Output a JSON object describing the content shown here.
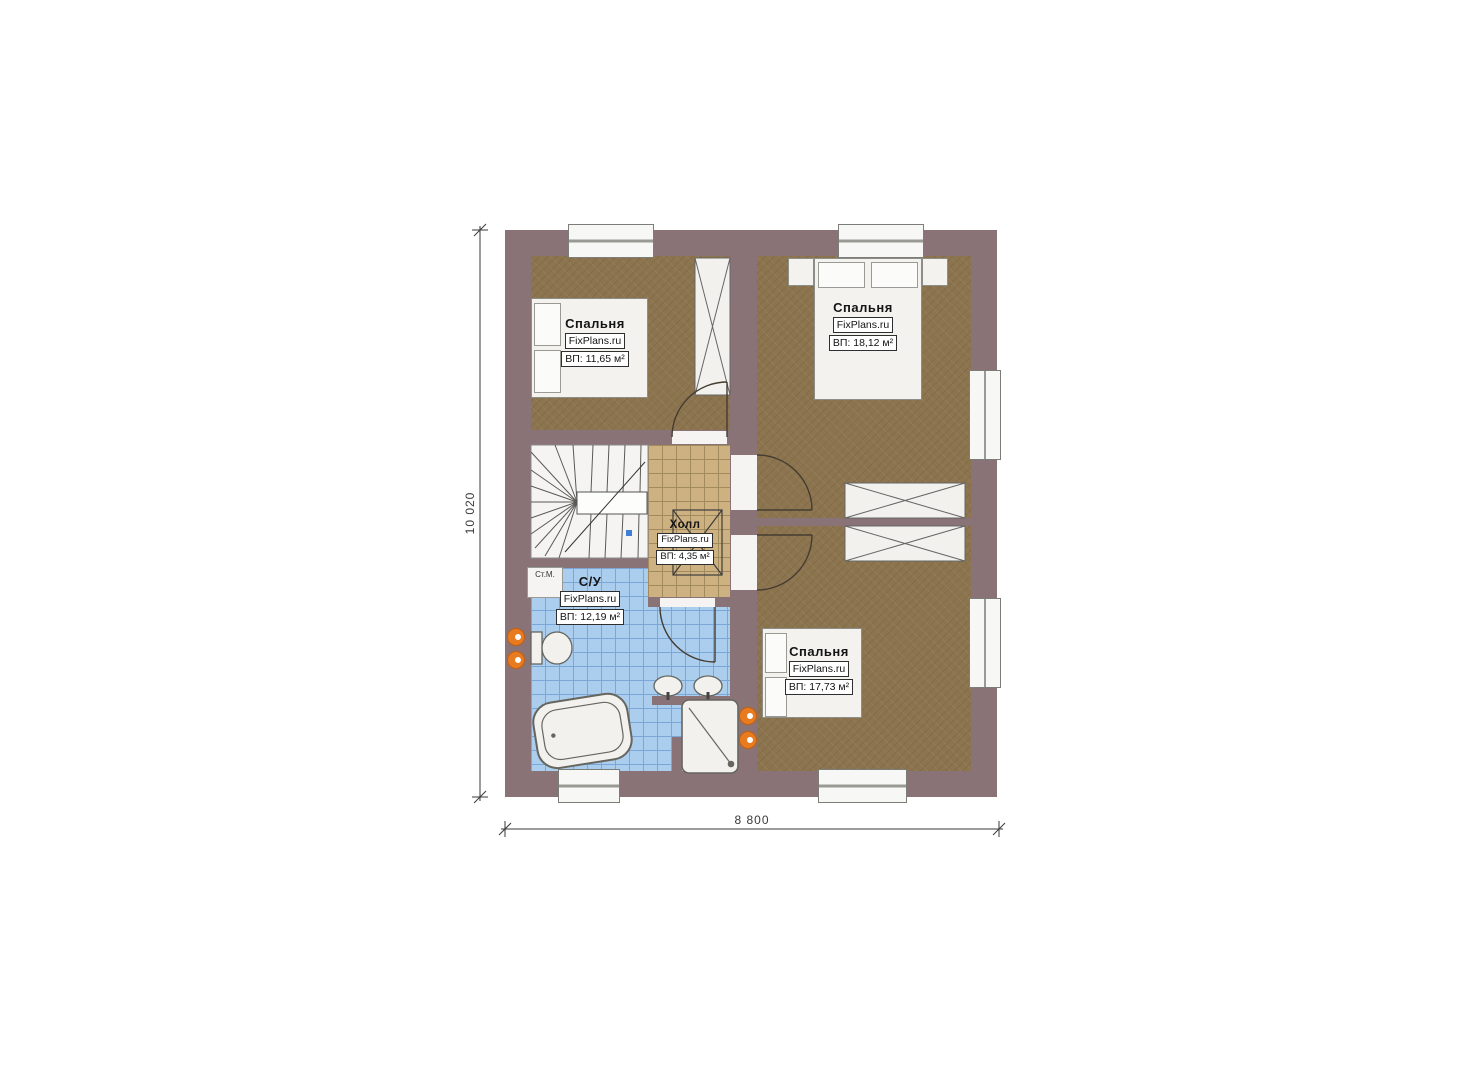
{
  "plan": {
    "rooms": {
      "bedroom_top_left": {
        "name": "Спальня",
        "brand": "FixPlans.ru",
        "area": "ВП: 11,65 м²"
      },
      "bedroom_top_right": {
        "name": "Спальня",
        "brand": "FixPlans.ru",
        "area": "ВП: 18,12 м²"
      },
      "bedroom_bottom_right": {
        "name": "Спальня",
        "brand": "FixPlans.ru",
        "area": "ВП: 17,73 м²"
      },
      "hall": {
        "name": "Холл",
        "brand": "FixPlans.ru",
        "area": "ВП: 4,35 м²"
      },
      "bathroom": {
        "name": "С/У",
        "brand": "FixPlans.ru",
        "area": "ВП: 12,19 м²"
      }
    },
    "annotations": {
      "washing_machine": "Ст.М."
    },
    "dimensions": {
      "width_label": "8 800",
      "height_label": "10 020"
    },
    "colors": {
      "wall": "#8a7377",
      "floor_wood": "#8c744f",
      "floor_hall": "#cdb181",
      "floor_bath": "#abcdee",
      "radiator": "#e87a1f"
    }
  }
}
